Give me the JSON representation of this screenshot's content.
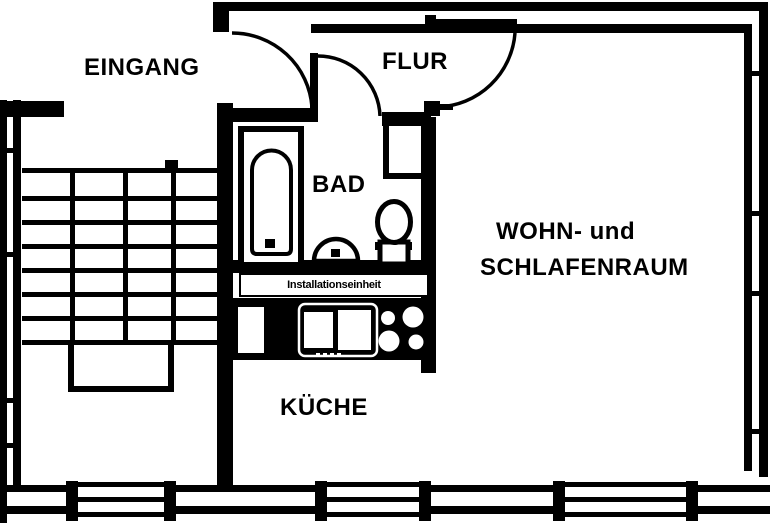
{
  "floorplan": {
    "type": "apartment-floor-plan",
    "colors": {
      "background": "#ffffff",
      "lines": "#000000"
    },
    "rooms": {
      "eingang": {
        "label": "EINGANG"
      },
      "flur": {
        "label": "FLUR"
      },
      "bad": {
        "label": "BAD"
      },
      "wohn_schlafraum": {
        "label_line1": "WOHN- und",
        "label_line2": "SCHLAFENRAUM"
      },
      "kueche": {
        "label": "KÜCHE"
      }
    },
    "annotations": {
      "installation_unit": "Installationseinheit"
    },
    "fixtures": {
      "bathtub": "bathtub",
      "washbasin": "washbasin",
      "toilet": "toilet",
      "stove": "stove-4-burners",
      "kitchen_sink": "double-basin-sink",
      "staircase": "staircase-with-landing",
      "windows": "3 exterior windows at bottom, window strips in left and right walls",
      "doors": "entrance door, bathroom door, living room door (swing arcs)"
    }
  }
}
